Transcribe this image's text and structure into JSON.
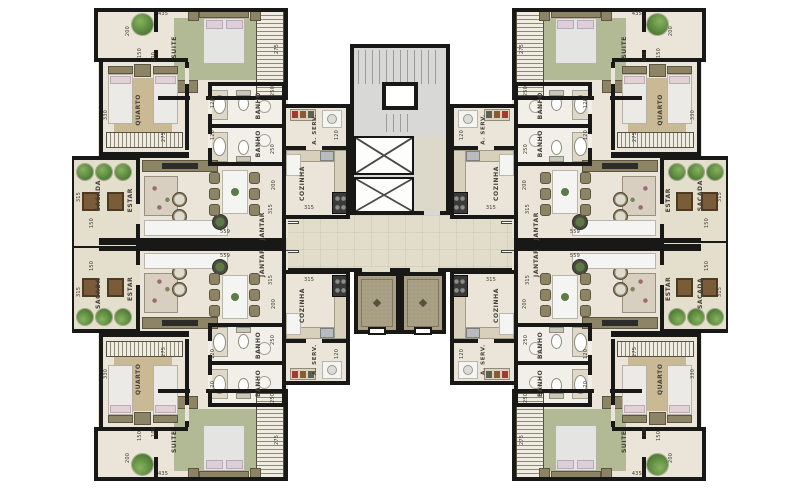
{
  "plan_title": "residential-floor-plan",
  "rooms": {
    "suite": "SUITE",
    "quarto": "QUARTO",
    "banho": "BANHO",
    "sacada": "SACADA",
    "estar": "ESTAR",
    "jantar": "JANTAR",
    "cozinha": "COZINHA",
    "aserv": "A. SERV."
  },
  "dims": {
    "suite_w": "435",
    "suite_d": "275",
    "closet_w": "200",
    "closet_d": "150",
    "passage": "100",
    "quarto_d": "330",
    "quarto_w": "275",
    "banho_w": "250",
    "banho_d": "120",
    "aserv_w": "120",
    "cozinha_d": "200",
    "cozinha_w": "315",
    "jantar_d": "315",
    "sacada_d": "315",
    "sacada_w": "150",
    "living_wall": "559"
  },
  "colors": {
    "wall": "#181816",
    "floor": "#eae5d8",
    "bath": "#f1efe8",
    "balcony": "#e4decd",
    "corridor": "#e2dcca",
    "hall": "#a9a086",
    "stair": "#d8d8d6",
    "rug_green": "#b2b995",
    "rug_tan": "#c9b995",
    "olive": "#8d8365",
    "wood": "#7a5c38",
    "white_furn": "#f4f4f2",
    "plant": "#4f7d35",
    "label": "#45413a",
    "hatch": "#8d887a"
  }
}
